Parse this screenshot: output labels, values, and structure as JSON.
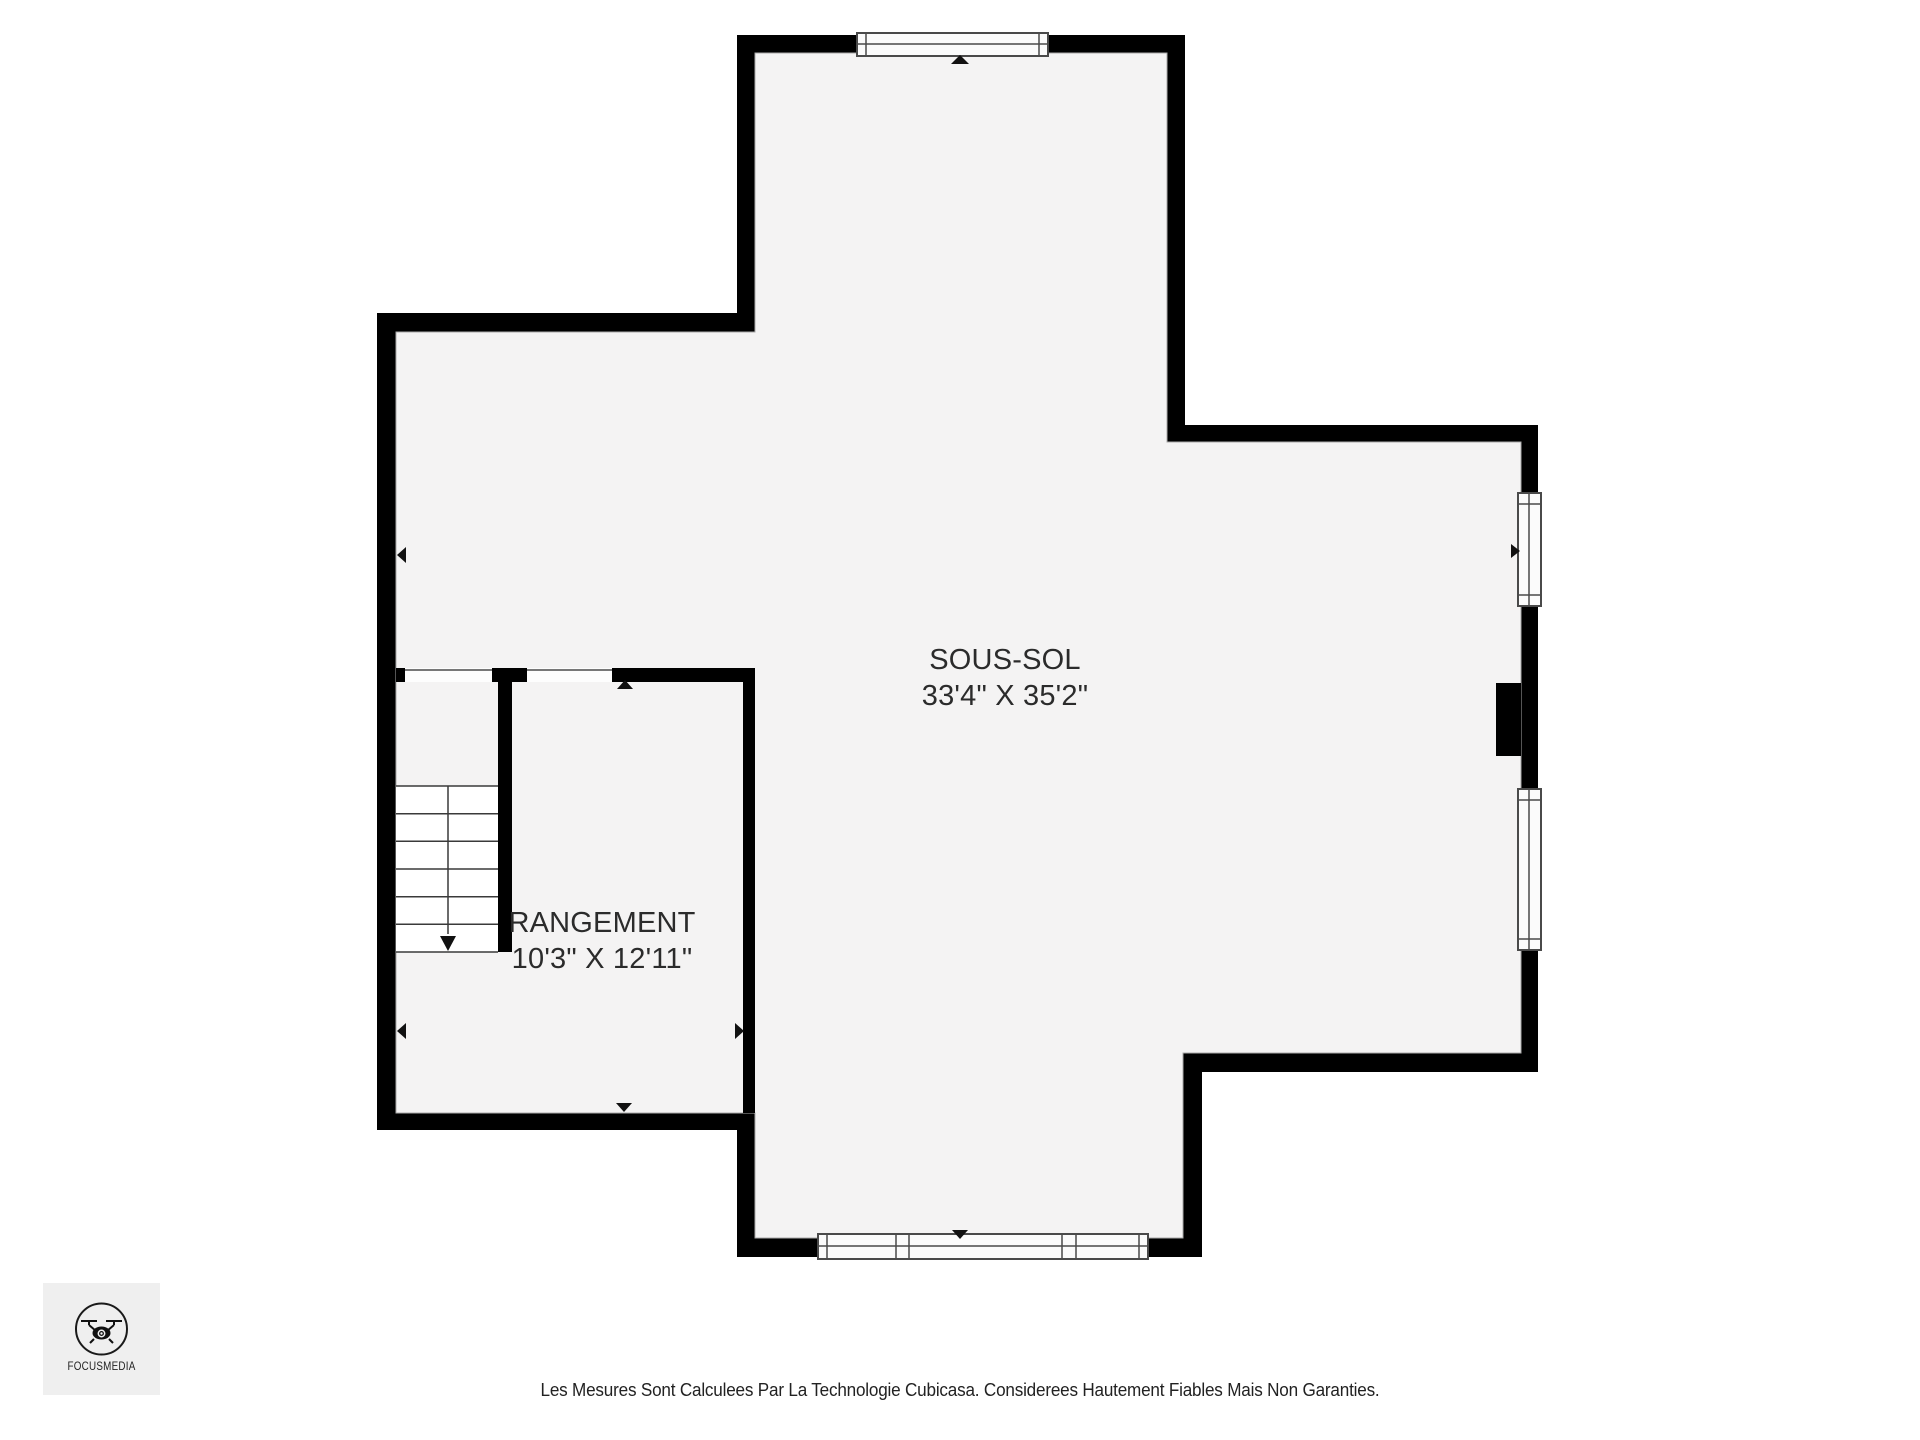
{
  "floorplan": {
    "rooms": [
      {
        "name": "SOUS-SOL",
        "dimensions": "33'4\" X 35'2\""
      },
      {
        "name": "RANGEMENT",
        "dimensions": "10'3\" X 12'11\""
      }
    ],
    "features": [
      "staircase-down",
      "window-top",
      "window-right-upper",
      "window-right-lower",
      "window-bottom-triple",
      "fireplace-bump",
      "door-opening-1",
      "door-opening-2"
    ],
    "colors": {
      "wall": "#000000",
      "floor": "#f4f3f3",
      "outside": "#ffffff",
      "window_fill": "#fbfbfb",
      "window_frame": "#4a4a4a",
      "marker": "#111111",
      "label_text": "#2b2b2b",
      "logo_background": "#efefef"
    }
  },
  "branding": {
    "name": "FOCUSMEDIA"
  },
  "footer": {
    "disclaimer": "Les Mesures Sont Calculees Par La Technologie Cubicasa. Considerees Hautement Fiables Mais Non Garanties."
  }
}
